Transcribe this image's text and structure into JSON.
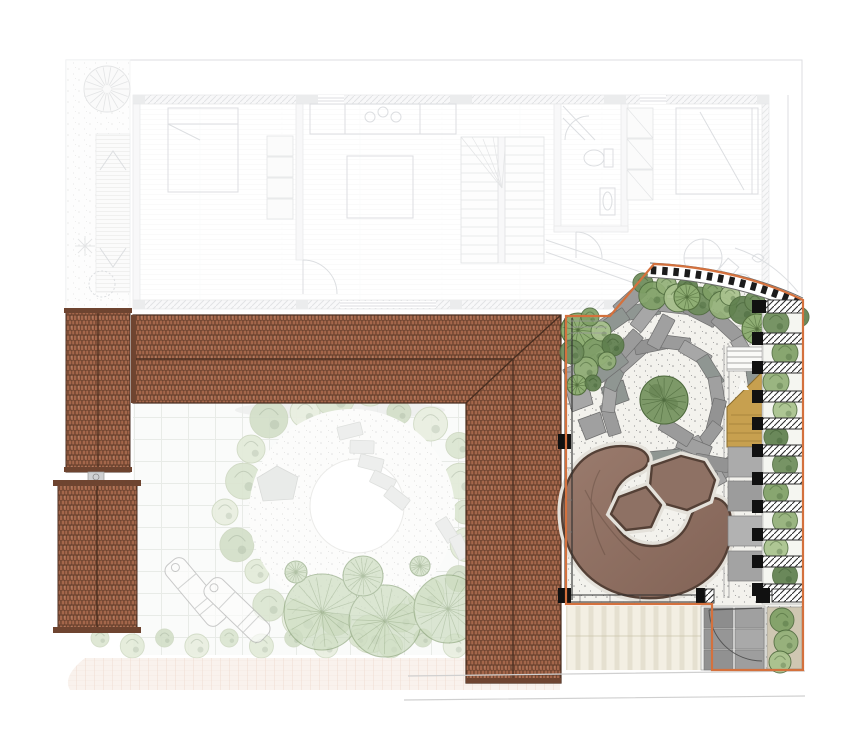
{
  "document": {
    "kind": "landscape-architecture-plan",
    "view": "top-down site plan with faded upper floor plan and highlighted garden design"
  },
  "palette": {
    "planStroke": "#9aa0a8",
    "roofBase": "#a5674b",
    "roofJoint": "#5e3b29",
    "roofEdge": "#4a2e20",
    "roofCap": "#6e4430",
    "orange": "#d4713d",
    "gravel": "#f3f2ed",
    "stippleDot": "#8f8f8f",
    "paverStroke": "#6f6f6f",
    "deck": "#8e7164",
    "deckDark": "#544036",
    "deckHalo": "#e4e1da",
    "stair": "#c7a04f",
    "stairEdge": "#8a6c2c",
    "wall": "#2e2e2e",
    "gridLine": "#ccd3c9",
    "beige": "#ece7d4",
    "beigeLine": "#d6d0ba",
    "courtyardTreeFill": "#ccdcc0",
    "courtyardTreeStroke": "#8fa77e",
    "paverGrays": [
      "#9b9b9b",
      "#a7a7a7",
      "#8f9692",
      "#a0a0a0",
      "#939393"
    ],
    "slabGrays": [
      "#ababab",
      "#9c9c9c",
      "#b2b2b2",
      "#a3a3a3"
    ],
    "tileGrays": [
      "#8d8d8d",
      "#a0a0a0",
      "#969696",
      "#a9a9a9",
      "#919191",
      "#9e9e9e"
    ],
    "greensBright": [
      "#6d8c5a",
      "#7fa066",
      "#93b078",
      "#a9c28d",
      "#5f7f4e"
    ],
    "greensSoft": [
      "#8fae74",
      "#a3bd88",
      "#b7cb9a",
      "#7d9a69"
    ],
    "greensPale": [
      "#b9cda4",
      "#c8d8b4",
      "#a8c094",
      "#d4e0c2"
    ]
  },
  "drawing": {
    "patio": {
      "center_tree": {
        "x": 664,
        "y": 400,
        "r": 24
      },
      "paver_rings": [
        {
          "r": 56,
          "count": 13,
          "a0": 160,
          "a1": 448,
          "w": 13,
          "h": 32
        },
        {
          "r": 95,
          "count": 13,
          "a0": -140,
          "a1": 80,
          "w": 14,
          "h": 34
        }
      ],
      "extra_pavers": [
        [
          630,
          300,
          48
        ],
        [
          646,
          315,
          38
        ],
        [
          612,
          323,
          55
        ],
        [
          661,
          332,
          28
        ],
        [
          594,
          346,
          60
        ],
        [
          627,
          346,
          42
        ],
        [
          581,
          369,
          65
        ],
        [
          611,
          367,
          52
        ],
        [
          694,
          447,
          112
        ],
        [
          712,
          463,
          100
        ],
        [
          676,
          432,
          122
        ],
        [
          700,
          478,
          96
        ]
      ],
      "angular_stones": [
        [
          [
            574,
            362
          ],
          [
            596,
            354
          ],
          [
            601,
            374
          ],
          [
            580,
            382
          ]
        ],
        [
          [
            566,
            390
          ],
          [
            588,
            384
          ],
          [
            593,
            404
          ],
          [
            572,
            412
          ]
        ],
        [
          [
            601,
            388
          ],
          [
            623,
            380
          ],
          [
            629,
            400
          ],
          [
            607,
            408
          ]
        ],
        [
          [
            578,
            420
          ],
          [
            600,
            412
          ],
          [
            606,
            432
          ],
          [
            586,
            440
          ]
        ]
      ],
      "bed_circles": [
        [
          578,
          330,
          17,
          1
        ],
        [
          596,
          352,
          14,
          0
        ],
        [
          586,
          369,
          12,
          0
        ],
        [
          601,
          331,
          10,
          0
        ],
        [
          613,
          345,
          11,
          0
        ],
        [
          572,
          352,
          12,
          0
        ],
        [
          590,
          317,
          9,
          0
        ],
        [
          607,
          361,
          9,
          0
        ],
        [
          577,
          385,
          10,
          1
        ],
        [
          593,
          383,
          8,
          0
        ]
      ],
      "band_trees": [
        [
          687,
          297,
          13
        ],
        [
          757,
          329,
          15
        ]
      ],
      "band_count": 15,
      "pads_count": 14,
      "planter_bars_y": [
        301,
        333,
        362,
        391,
        418,
        445,
        473,
        501,
        529,
        556,
        584
      ],
      "lower_planter_shrubs": [
        [
          782,
          620,
          12
        ],
        [
          786,
          642,
          12
        ],
        [
          780,
          662,
          11
        ]
      ],
      "stair_step_lines": 4,
      "slabs_y": [
        447,
        481,
        516,
        551
      ],
      "door_tiles": {
        "cols": 2,
        "rows": 3,
        "x": 704,
        "y": 608,
        "cw": 29,
        "ch": 20
      }
    },
    "courtyard": {
      "ring": {
        "cx": 352,
        "cy": 512,
        "r": 120,
        "count": 22
      },
      "inner_r": 103,
      "center_circle": {
        "cx": 357,
        "cy": 506,
        "r": 47
      },
      "pentagon": [
        [
          257,
          478
        ],
        [
          277,
          466
        ],
        [
          298,
          477
        ],
        [
          293,
          499
        ],
        [
          263,
          501
        ]
      ],
      "stones": [
        [
          350,
          431,
          -14
        ],
        [
          362,
          447,
          2
        ],
        [
          371,
          463,
          14
        ],
        [
          383,
          481,
          26
        ],
        [
          397,
          498,
          38
        ],
        [
          520,
          506,
          78
        ],
        [
          532,
          524,
          84
        ],
        [
          447,
          530,
          58
        ],
        [
          460,
          547,
          64
        ]
      ],
      "trees": [
        [
          322,
          612,
          38
        ],
        [
          385,
          621,
          36
        ],
        [
          448,
          609,
          34
        ],
        [
          363,
          576,
          20
        ],
        [
          296,
          572,
          11
        ],
        [
          420,
          566,
          10
        ]
      ],
      "chairs": [
        [
          196,
          592,
          140
        ],
        [
          237,
          610,
          134
        ]
      ],
      "hedge": {
        "x1": 100,
        "x2": 552,
        "y": 641,
        "count": 15
      }
    }
  }
}
